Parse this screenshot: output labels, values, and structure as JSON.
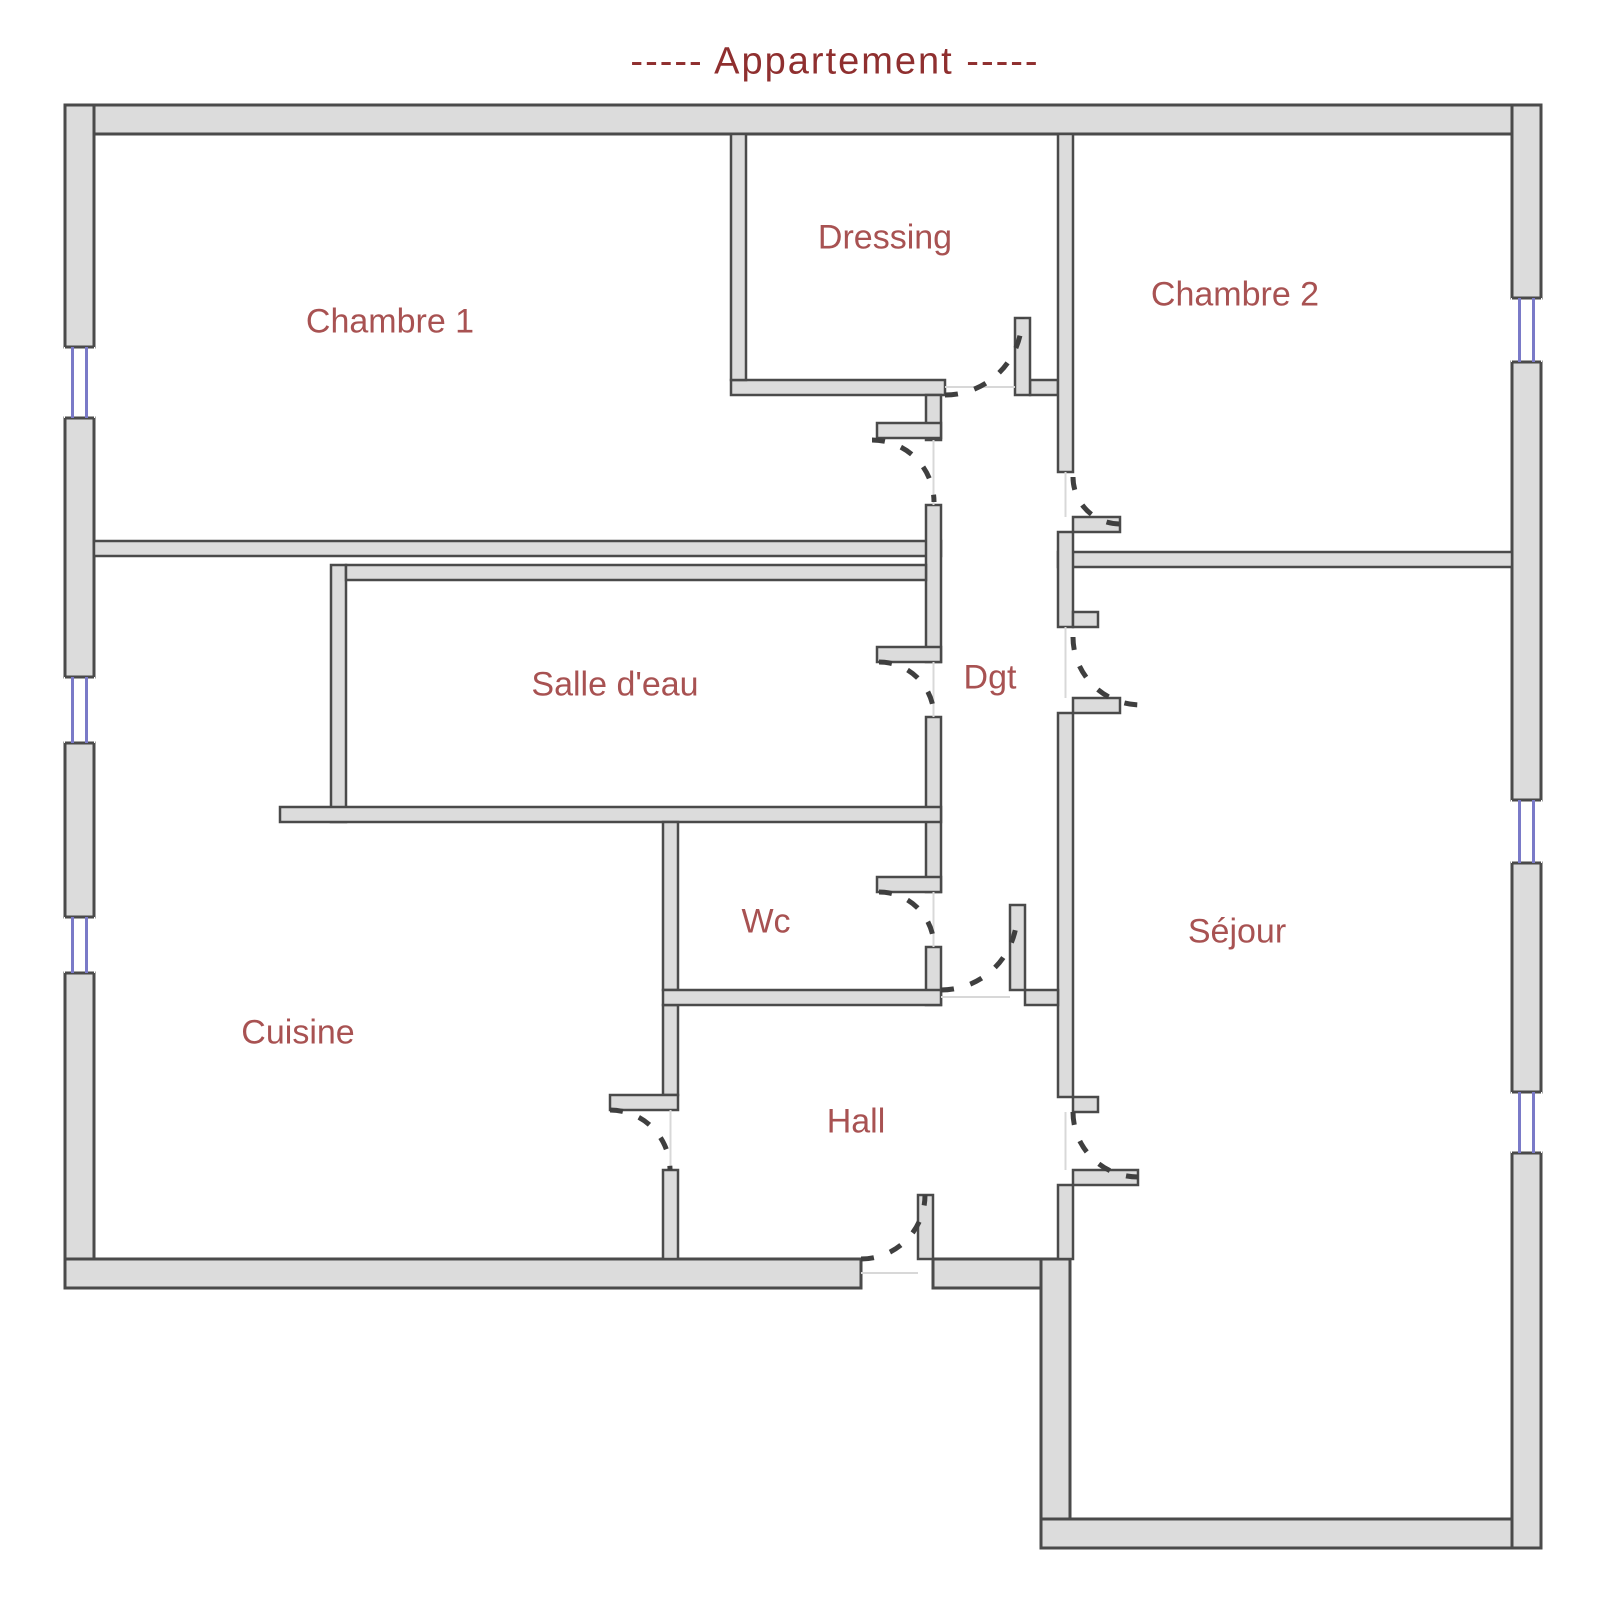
{
  "title": "-----  Appartement  -----",
  "colors": {
    "wall_fill": "#dcdcdc",
    "wall_stroke": "#4a4a4a",
    "window_glass": "#7a7ac8",
    "label_color": "#a85252",
    "title_color": "#8f2f2f"
  },
  "rooms": [
    {
      "id": "chambre-1",
      "label": "Chambre 1"
    },
    {
      "id": "dressing",
      "label": "Dressing"
    },
    {
      "id": "chambre-2",
      "label": "Chambre 2"
    },
    {
      "id": "salle-d-eau",
      "label": "Salle d'eau"
    },
    {
      "id": "dgt",
      "label": "Dgt"
    },
    {
      "id": "wc",
      "label": "Wc"
    },
    {
      "id": "cuisine",
      "label": "Cuisine"
    },
    {
      "id": "hall",
      "label": "Hall"
    },
    {
      "id": "sejour",
      "label": "Séjour"
    }
  ]
}
